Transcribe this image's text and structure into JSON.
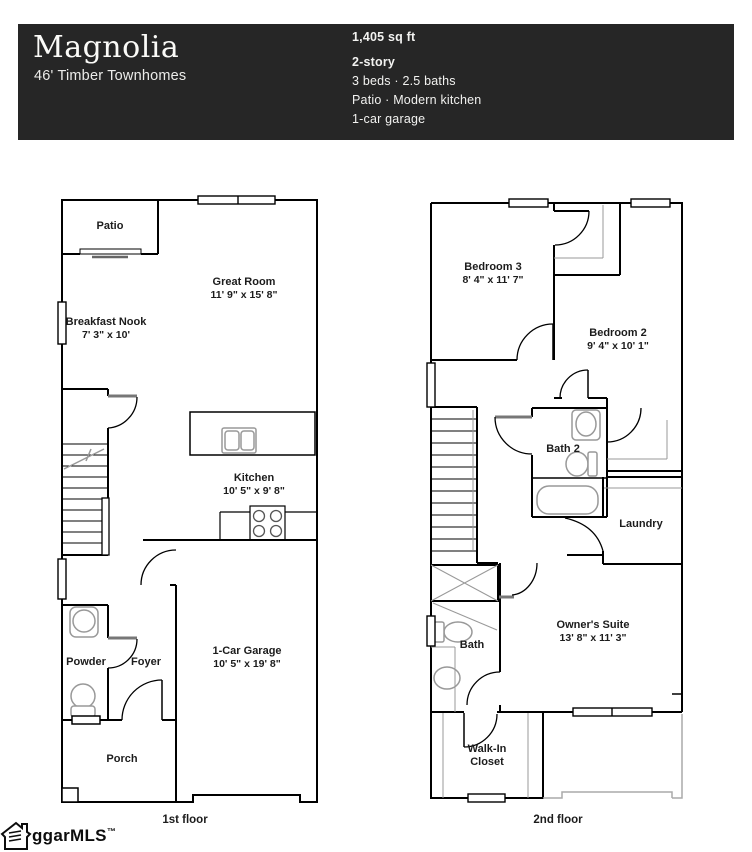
{
  "header": {
    "title": "Magnolia",
    "subtitle": "46' Timber Townhomes",
    "sqft": "1,405 sq ft",
    "stories": "2-story",
    "beds_baths": "3 beds  ·  2.5 baths",
    "features": "Patio · Modern kitchen",
    "garage": "1-car garage"
  },
  "floor1": {
    "caption": "1st floor",
    "rooms": {
      "patio": {
        "name": "Patio"
      },
      "great_room": {
        "name": "Great Room",
        "dims": "11' 9\" x 15' 8\""
      },
      "breakfast_nook": {
        "name": "Breakfast Nook",
        "dims": "7' 3\" x 10'"
      },
      "kitchen": {
        "name": "Kitchen",
        "dims": "10' 5\" x 9' 8\""
      },
      "garage": {
        "name": "1-Car Garage",
        "dims": "10' 5\" x 19' 8\""
      },
      "powder": {
        "name": "Powder"
      },
      "foyer": {
        "name": "Foyer"
      },
      "porch": {
        "name": "Porch"
      }
    }
  },
  "floor2": {
    "caption": "2nd floor",
    "rooms": {
      "bedroom3": {
        "name": "Bedroom 3",
        "dims": "8' 4\" x 11' 7\""
      },
      "bedroom2": {
        "name": "Bedroom 2",
        "dims": "9' 4\" x 10' 1\""
      },
      "bath2": {
        "name": "Bath 2"
      },
      "laundry": {
        "name": "Laundry"
      },
      "bath": {
        "name": "Bath"
      },
      "owners_suite": {
        "name": "Owner's Suite",
        "dims": "13' 8\" x 11' 3\""
      },
      "walk_in_closet": {
        "name": "Walk-In Closet"
      }
    }
  },
  "logo": {
    "text": "ggarMLS",
    "tm": "™"
  },
  "colors": {
    "header_bg": "#262626",
    "wall": "#000000",
    "fixture": "#999999"
  }
}
